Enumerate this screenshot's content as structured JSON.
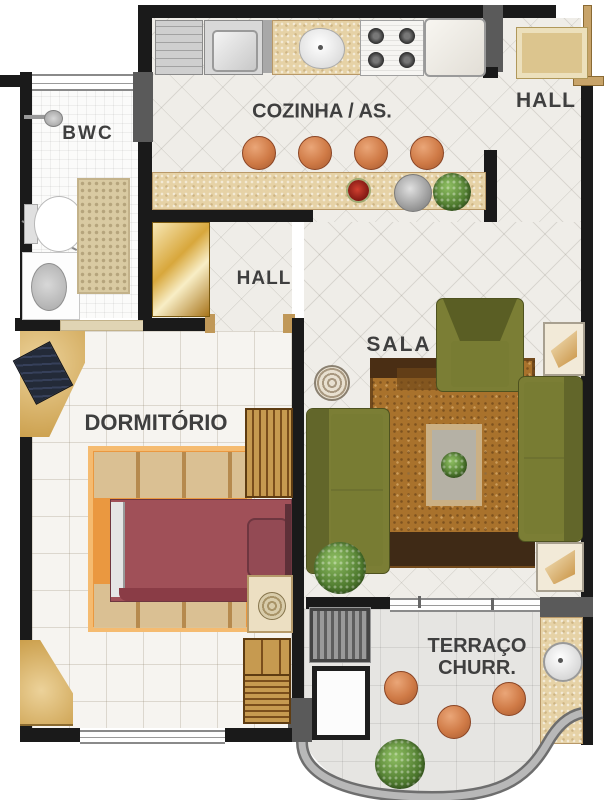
{
  "rooms": {
    "bwc": {
      "label": "BWC"
    },
    "cozinha": {
      "label": "COZINHA / AS."
    },
    "hall_externo": {
      "label": "HALL"
    },
    "hall_interno": {
      "label": "HALL"
    },
    "sala": {
      "label": "SALA"
    },
    "dormitorio": {
      "label": "DORMITÓRIO"
    },
    "terraco": {
      "label_line1": "TERRAÇO",
      "label_line2": "CHURR."
    }
  },
  "colors": {
    "wall": "#1a1a1a",
    "wall-gray": "#5a5a5a",
    "floor-tile": "#efede8",
    "floor-bwc": "#fbfbfa",
    "floor-bedroom": "#f6f4f0",
    "floor-terrace": "#e6e5e2",
    "label": "#3f3f3f",
    "door-gold": "#d8a73c",
    "granite": "#e6d2a6",
    "olive": "#7b7e35",
    "rug-brown": "#a9722c",
    "bed": "#a05058",
    "rug-orange": "#ea9840",
    "stool": "#cf7a46",
    "wood": "#c69a50",
    "green": "#4e7a2e"
  }
}
